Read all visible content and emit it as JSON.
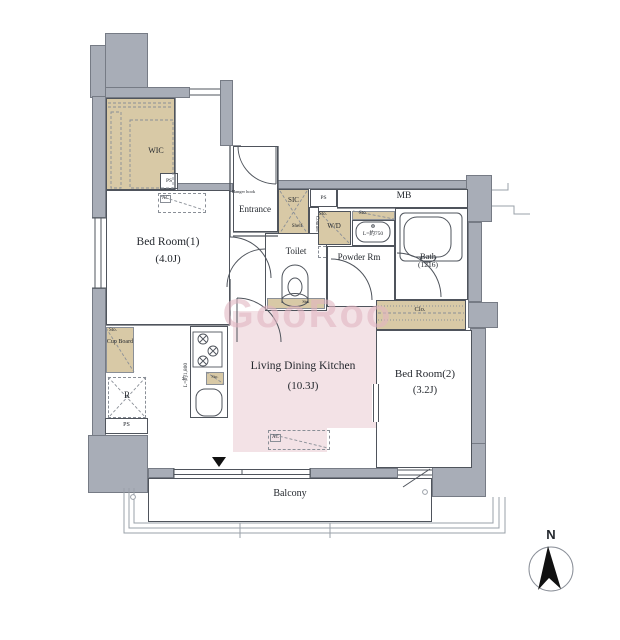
{
  "labels": {
    "wic": "WIC",
    "ps": "PS",
    "ac": "AC",
    "bedroom1": "Bed Room(1)",
    "bedroom1_size": "(4.0J)",
    "hanger_hook": "Hanger hook",
    "entrance": "Entrance",
    "sic": "SIC",
    "shelf": "Shelf",
    "counter": "Counter",
    "mb": "MB",
    "toilet": "Toilet",
    "sto": "Sto.",
    "wd": "W/D",
    "vanity_length": "L=約750",
    "powder_rm": "Powder Rm",
    "bath": "Bath",
    "bath_size": "(1216)",
    "closet": "Clo.",
    "bedroom2": "Bed Room(2)",
    "bedroom2_size": "(3.2J)",
    "ldk": "Living Dining Kitchen",
    "ldk_size": "(10.3J)",
    "cupboard": "Cup Board",
    "fridge": "R",
    "kitchen_counter_length": "L=約1,800",
    "balcony": "Balcony",
    "compass_north": "N",
    "watermark": "GooRoo"
  },
  "colors": {
    "closet_fill": "#d8c9a6",
    "ldk_fill": "#f3e2e6",
    "wall_fill": "#a8adb7",
    "line": "#4f545c",
    "watermark_pink": "#e2b6c2"
  }
}
